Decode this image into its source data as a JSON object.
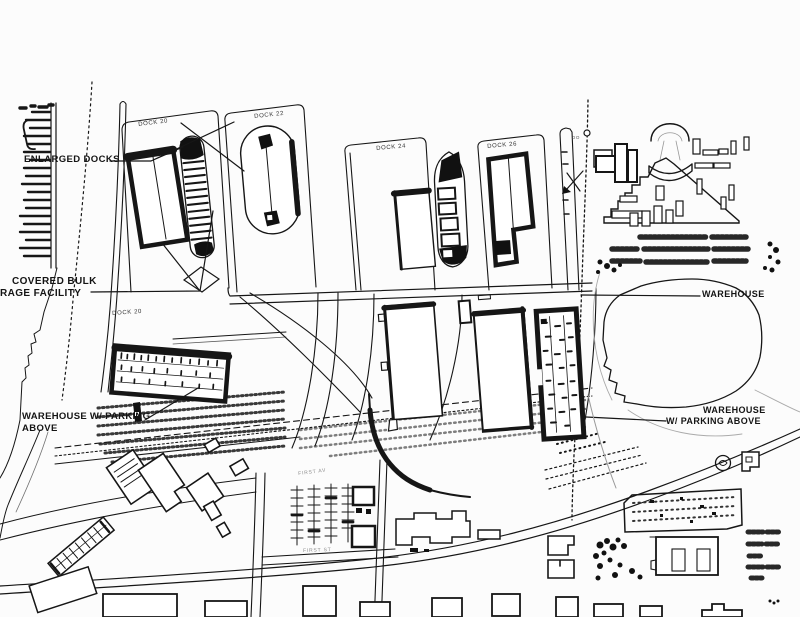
{
  "document": {
    "title": "Port waterfront site plan",
    "type": "scanned black-and-white architectural site plan drawing"
  },
  "colors": {
    "paper": "#fcfcfc",
    "ink": "#161616",
    "faint": "#9a9a9a"
  },
  "annotations": {
    "enlarged_docks": "ENLARGED DOCKS",
    "covered_bulk_storage": {
      "line1": "COVERED BULK",
      "line2": "RAGE FACILITY"
    },
    "warehouse_right": "WAREHOUSE",
    "warehouse_parking_right": {
      "line1": "WAREHOUSE",
      "line2": "W/ PARKING ABOVE"
    },
    "warehouse_parking_left": {
      "line1": "WAREHOUSE W/ PARKING",
      "line2": "ABOVE"
    }
  },
  "docks": {
    "dock_20_slip": "DOCK 20",
    "dock_22": "DOCK 22",
    "dock_24": "DOCK 24",
    "dock_26": "DOCK 26",
    "dock_20_area": "DOCK 20",
    "dock_28_partial": "DO"
  },
  "streets": {
    "avenue": "FIRST AV",
    "street": "FIRST ST"
  }
}
